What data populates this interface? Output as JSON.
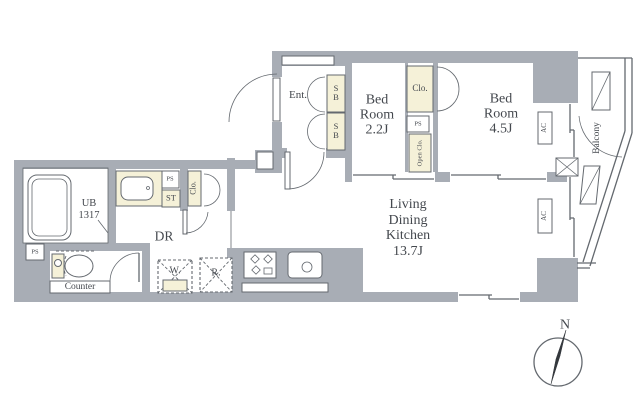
{
  "colors": {
    "wall": "#a8adb5",
    "line": "#64696f",
    "beige": "#f5f1d8",
    "text": "#44484e"
  },
  "rooms": {
    "entrance": {
      "label": "Ent."
    },
    "bedroom_2_2": {
      "lines": [
        "Bed",
        "Room",
        "2.2J"
      ]
    },
    "bedroom_4_5": {
      "lines": [
        "Bed",
        "Room",
        "4.5J"
      ]
    },
    "ldk": {
      "lines": [
        "Living",
        "Dining",
        "Kitchen",
        "13.7J"
      ]
    },
    "unit_bath": {
      "lines": [
        "UB",
        "1317"
      ]
    },
    "dressing_room": {
      "label": "DR"
    },
    "balcony": {
      "label": "Balcony"
    }
  },
  "fixtures": {
    "shoe_box_1": "SB",
    "shoe_box_2": "SB",
    "closet_bedroom": "Clo.",
    "closet_hall": "Clo.",
    "open_closet": "Open Clo.",
    "storage": "ST",
    "pipe_space_1": "PS",
    "pipe_space_2": "PS",
    "pipe_space_3": "PS",
    "washer": "W.",
    "refrigerator": "R.",
    "counter": "Counter",
    "ac_1": "AC",
    "ac_2": "AC"
  },
  "compass": {
    "north": "N"
  }
}
